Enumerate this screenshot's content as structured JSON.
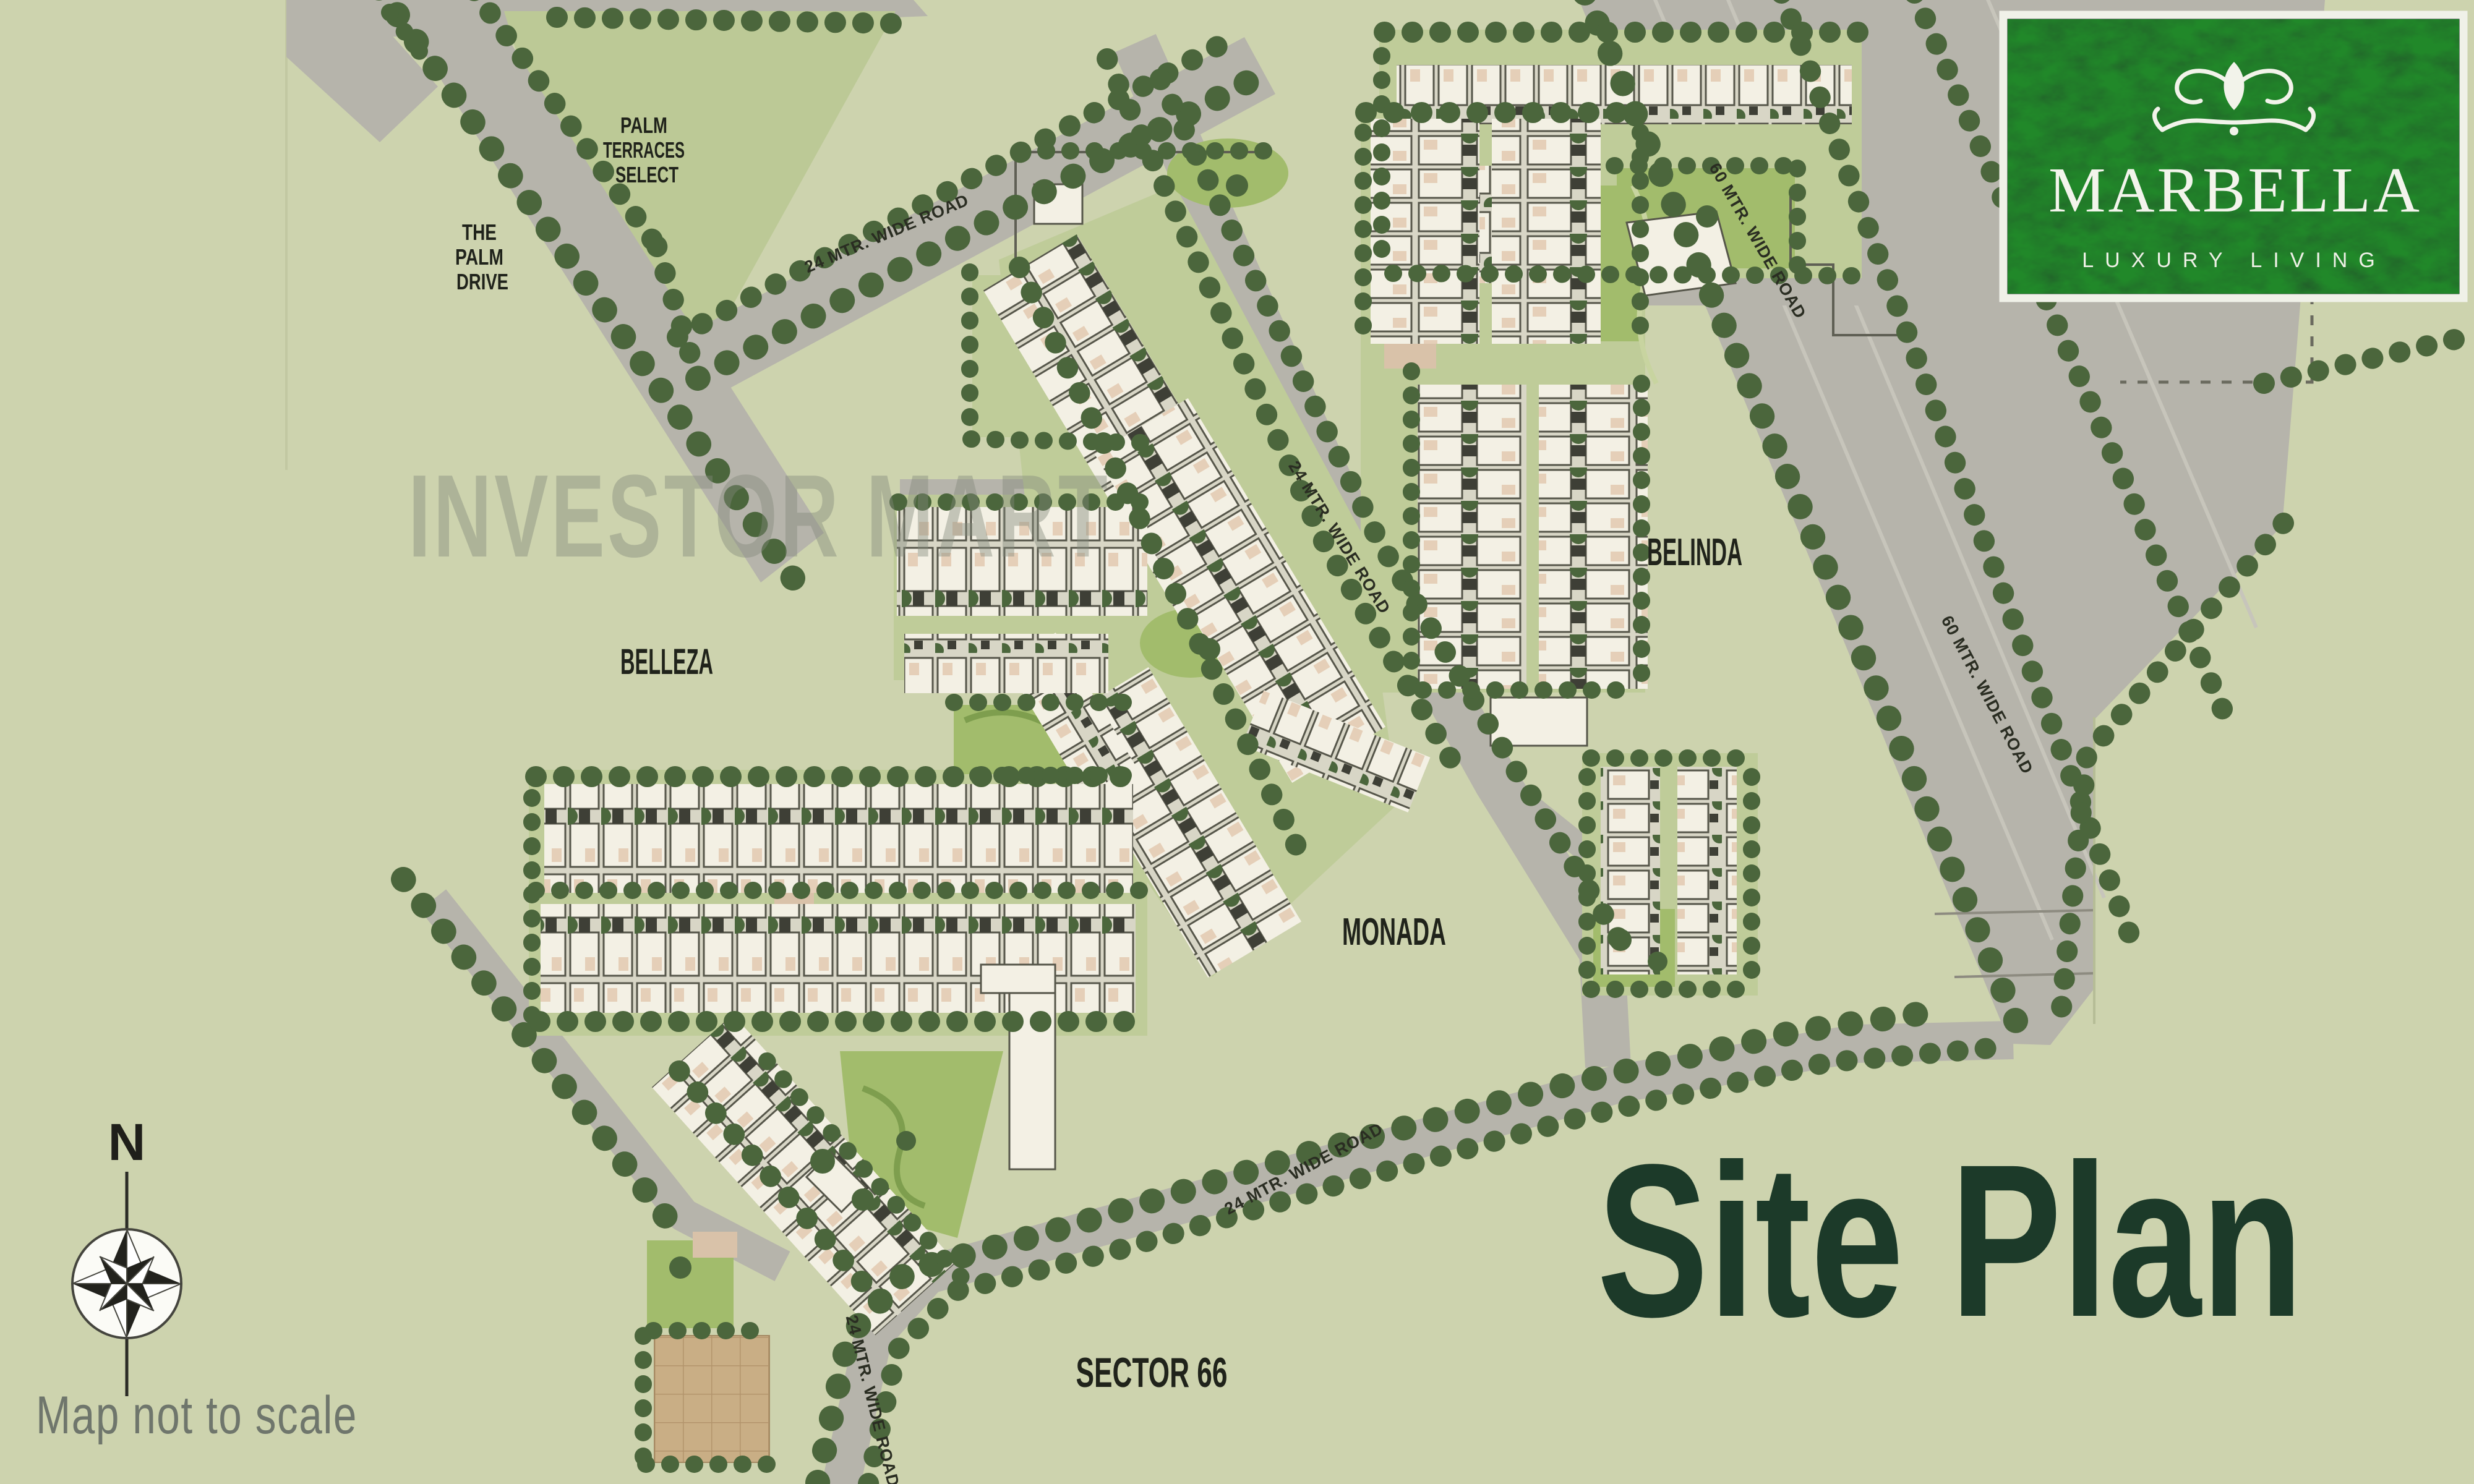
{
  "branding": {
    "logo_title": "MARBELLA",
    "logo_tagline": "LUXURY LIVING"
  },
  "headline": "Site Plan",
  "watermark": "INVESTOR MART",
  "footnote": "Map not to scale",
  "sector_label": "SECTOR 66",
  "compass": {
    "north_label": "N"
  },
  "areas": {
    "palm_terraces": [
      "PALM",
      "TERRACES",
      "SELECT"
    ],
    "palm_drive": [
      "THE",
      "PALM",
      "DRIVE"
    ],
    "belinda": "BELINDA",
    "belleza": "BELLEZA",
    "monada": "MONADA"
  },
  "road_labels": [
    {
      "text": "24 MTR. WIDE ROAD"
    },
    {
      "text": "24 MTR. WIDE ROAD"
    },
    {
      "text": "60 MTR. WIDE ROAD"
    },
    {
      "text": "60 MTR. WIDE ROAD"
    },
    {
      "text": "24 MTR. WIDE ROAD"
    },
    {
      "text": "24 MTR. WIDE ROAD"
    }
  ],
  "colors": {
    "background": "#cdd3ae",
    "road": "#b6b4ab",
    "tree": "#4b663c",
    "park": "#a2bc6c",
    "lawn": "#bfcc99",
    "building": "#f3f0e4",
    "headline_green": "#1c3a29",
    "logo_background": "#0e2517",
    "label_ink": "#20231b",
    "watermark_gray": "#82897b"
  }
}
